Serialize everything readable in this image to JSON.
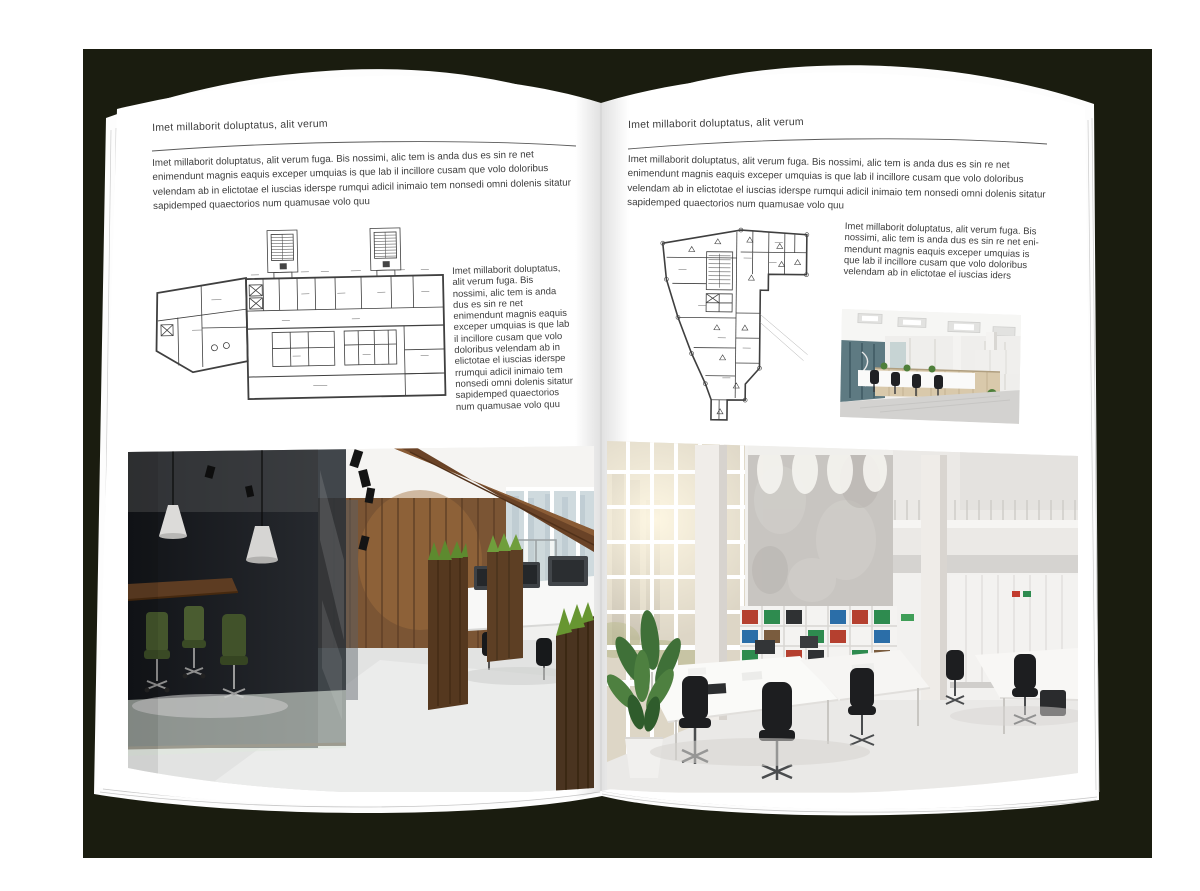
{
  "scene": {
    "description": "open-brochure-mockup-on-dark-background",
    "background_color": "#1a1c0f",
    "page_color": "#ffffff"
  },
  "left_page": {
    "heading": "Imet millaborit doluptatus, alit verum",
    "intro": "Imet millaborit doluptatus, alit verum fuga. Bis nossimi, alic tem is anda dus es sin re net enimendunt magnis eaquis exceper umquias is que lab il incillore cusam que volo doloribus velendam ab in elictotae el iuscias iderspe rumqui adicil inimaio tem nonsedi omni dolenis sitatur sapidemped quaectorios num quamusae volo quu",
    "caption": "Imet millaborit doluptatus, alit verum fuga. Bis nossimi, alic tem is anda dus es sin re net enimendunt magnis eaquis exceper umquias is que lab il incillore cusam que volo doloribus velendam ab in elictotae el iuscias iderspe rrumqui adicil inimaio tem nonsedi omni dolenis sitatur sapidemped quaectorios num quamusae volo quu",
    "images": {
      "floorplan": "architectural-second-floor-plan-drawing",
      "photo": "loft-office-interior-photo-dark-glass-meeting-room-wood-wall"
    }
  },
  "right_page": {
    "heading": "Imet millaborit doluptatus, alit verum",
    "intro": "Imet millaborit doluptatus, alit verum fuga. Bis nossimi, alic tem is anda dus es sin re net enimendunt magnis eaquis exceper umquias is que lab il incillore cusam que volo doloribus velendam ab in elictotae el iuscias iderspe rumqui adicil inimaio tem nonsedi omni dolenis sitatur sapidemped quaectorios num quamusae volo quu",
    "caption": "Imet millaborit doluptatus, alit verum fuga. Bis nossimi, alic tem is anda dus es sin re net eni-mendunt magnis eaquis exceper umquias is que lab il incillore cusam que volo doloribus velendam ab in elictotae el iuscias iders",
    "images": {
      "floorplan": "architectural-irregular-floor-plan-drawing",
      "photo_small": "modern-office-photo-desks-and-wood-cabinets",
      "photo_large": "bright-double-height-office-photo-windows-bookshelves"
    }
  }
}
